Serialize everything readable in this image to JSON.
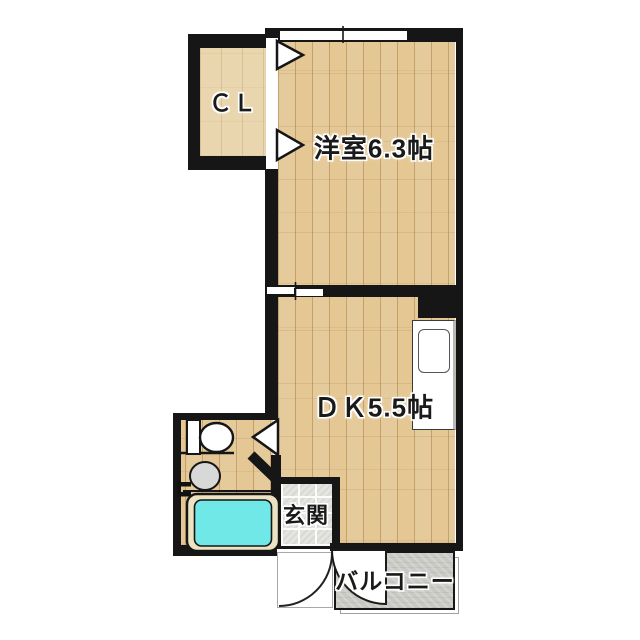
{
  "floorplan": {
    "labels": {
      "closet": "ＣＬ",
      "western_room": "洋室6.3帖",
      "dining_kitchen": "ＤＫ5.5帖",
      "entrance": "玄関",
      "balcony": "バルコニー"
    },
    "colors": {
      "background": "#ffffff",
      "wall": "#161616",
      "wood_base": "#eed7aa",
      "cl_floor": "#e9d6ae",
      "tile_base": "#e4e4e1",
      "balcony_floor": "#c9c9c4",
      "tub_water": "#6fe8e7",
      "tub_rim": "#ece3c3",
      "basin": "#d8d8d8"
    }
  }
}
